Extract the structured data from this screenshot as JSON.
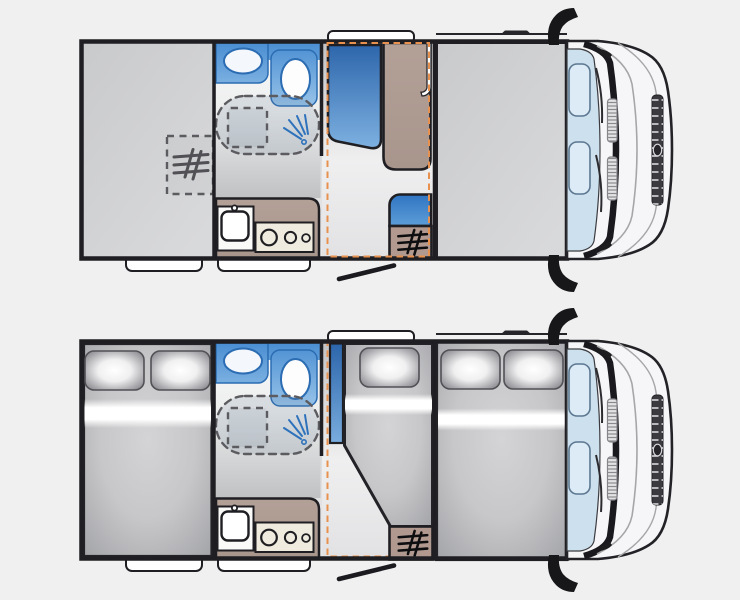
{
  "canvas": {
    "width": 740,
    "height": 600,
    "background": "#f0f0f1"
  },
  "colors": {
    "pageBg": "#f0f0f1",
    "wall": "#1f1f23",
    "orangeMarker": "#e8914e",
    "seatBlueDark": "#2d66ab",
    "seatBlueLight": "#7fb2e2",
    "bathBlueDark": "#4a8ed2",
    "bathBlueLight": "#9cc6ea",
    "blueOutline": "#2b6cb2",
    "furnitureTaupe": "#b3a097",
    "heaterTaupe": "#b1998f",
    "hobCream": "#f0ebdf",
    "mattressGray": "#c7c7c9",
    "floorGray": "#d6d6d8",
    "windshieldBlue": "#cde0ee",
    "cabBody": "#f6f6f8",
    "white": "#ffffff"
  },
  "plans": [
    {
      "id": "day-layout",
      "aria": "Motorhome floor plan, daytime configuration",
      "features": [
        "rear-lounge",
        "washroom",
        "shower",
        "toilet",
        "washbasin",
        "kitchen",
        "dinette-bench",
        "dinette-table",
        "side-seat",
        "heater-cabinet",
        "heater-marker",
        "bed-area-marker",
        "drop-down-bed-stowed",
        "entry-door",
        "driver-cab"
      ]
    },
    {
      "id": "night-layout",
      "aria": "Motorhome floor plan, night bed configuration",
      "features": [
        "rear-double-bed",
        "washroom",
        "shower",
        "toilet",
        "washbasin",
        "kitchen",
        "single-bed",
        "drop-down-double-bed",
        "heater-cabinet",
        "bed-area-marker",
        "entry-door",
        "driver-cab"
      ]
    }
  ]
}
